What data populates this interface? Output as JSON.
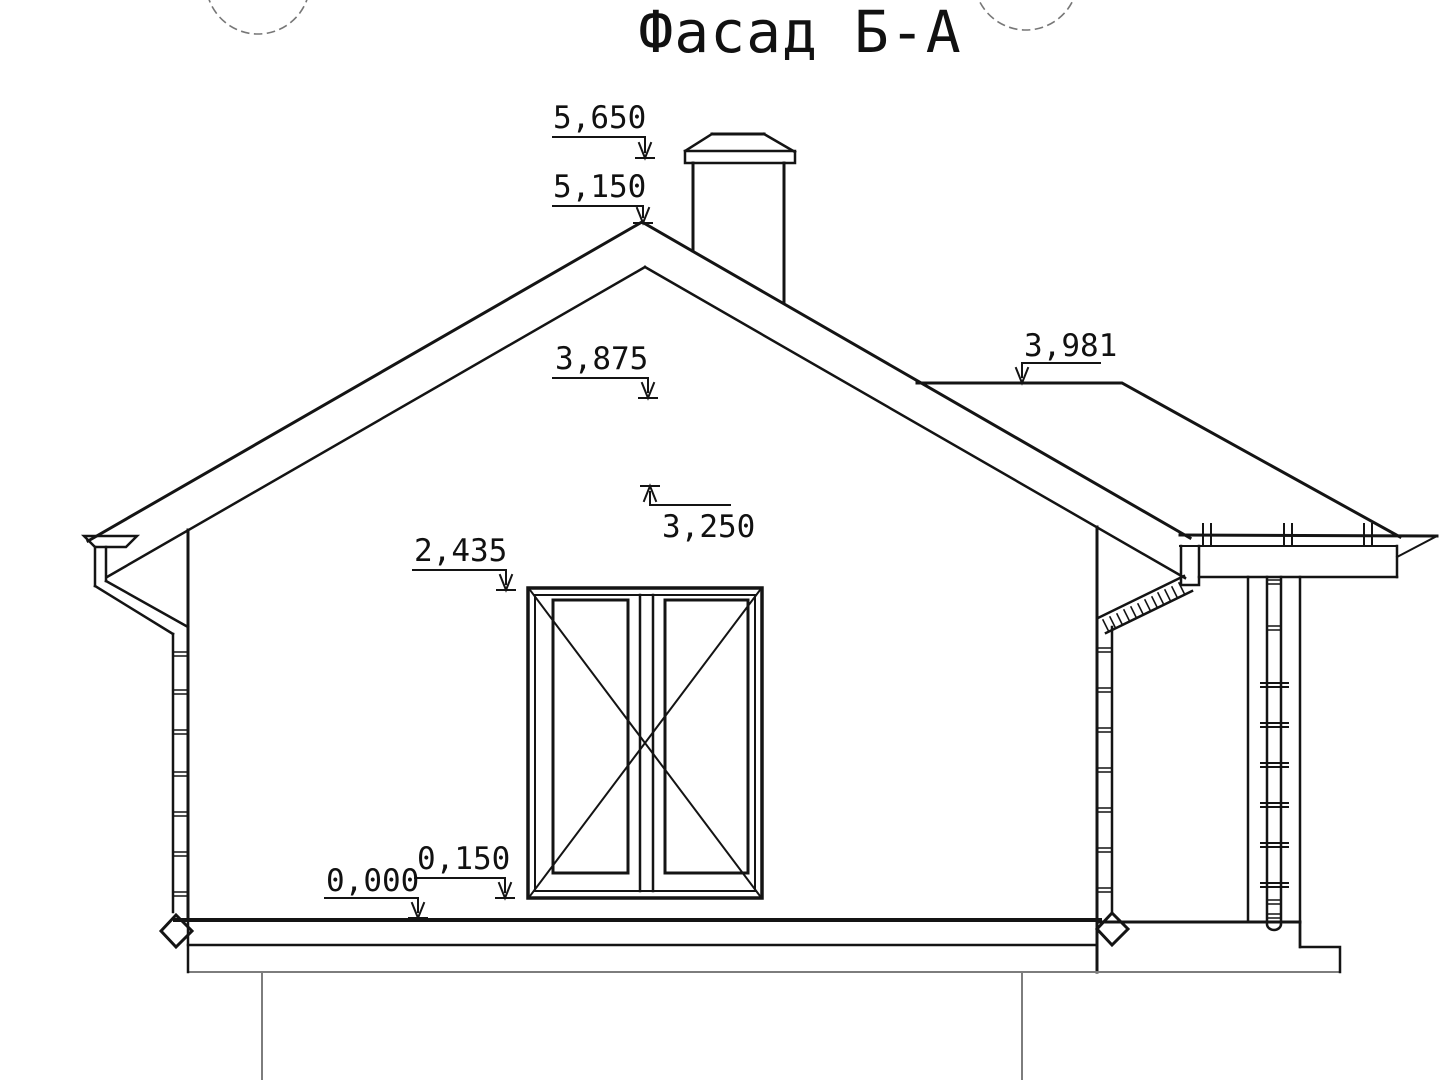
{
  "title": "Фасад Б-А",
  "dimensions": {
    "chimney_top": "5,650",
    "roof_ridge": "5,150",
    "eave": "3,875",
    "porch_roof": "3,981",
    "upper_level": "3,250",
    "window_top": "2,435",
    "plinth": "0,150",
    "ground": "0,000"
  }
}
